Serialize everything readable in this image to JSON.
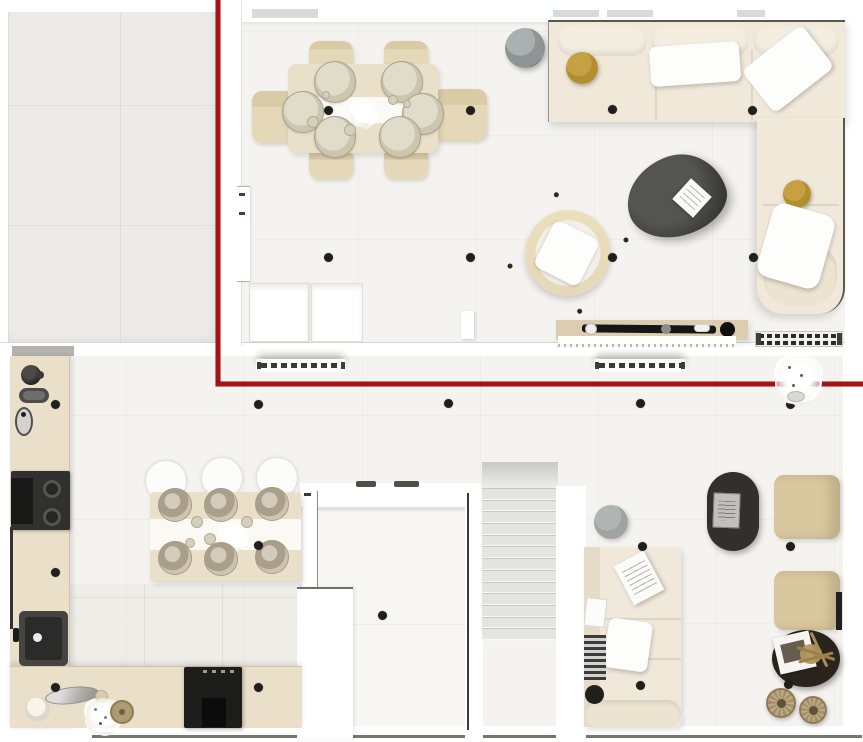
{
  "colors": {
    "wall": "#ffffff",
    "floor_main": "#f4f3f0",
    "floor_gray": "#ecebe7",
    "floor_hall": "#f7f6f3",
    "wood": "#eadfc8",
    "wood_dark": "#dccdb0",
    "chair_wood": "#e4d8b8",
    "cream": "#f0e8d9",
    "beige_chair": "#d9c79e",
    "mustard": "#b28e2f",
    "charcoal": "#343433",
    "black_item": "#1d1d1c",
    "gray_table": "#8f9494",
    "gray_pouf": "#9fa3a2",
    "wicker": "#b9a67e",
    "dark_table": "#2b241d",
    "annotation_red": "#a91113",
    "ceiling_dot": "#1f1f1e",
    "stair_tread": "#e4e4e2",
    "bottom_line": "#76746f"
  },
  "annotation": {
    "color": "#a91113",
    "vertical_line": {
      "x": 216,
      "y1": 0,
      "y2": 386,
      "thickness": 4
    },
    "horizontal_line": {
      "y": 382,
      "x1": 216,
      "x2": 863,
      "thickness": 4
    }
  },
  "ceiling_lights": [
    [
      328,
      110
    ],
    [
      470,
      110
    ],
    [
      612,
      109
    ],
    [
      752,
      110
    ],
    [
      328,
      257
    ],
    [
      470,
      257
    ],
    [
      612,
      257
    ],
    [
      753,
      257
    ],
    [
      55,
      404
    ],
    [
      258,
      404
    ],
    [
      448,
      403
    ],
    [
      640,
      403
    ],
    [
      790,
      404
    ],
    [
      55,
      572
    ],
    [
      258,
      545
    ],
    [
      382,
      615
    ],
    [
      642,
      546
    ],
    [
      790,
      546
    ],
    [
      640,
      685
    ],
    [
      788,
      684
    ],
    [
      55,
      687
    ],
    [
      258,
      687
    ]
  ],
  "stairs": {
    "tread_count": 13
  },
  "upper_dining": {
    "plate_radius": 21,
    "plates": [
      [
        335,
        82
      ],
      [
        402,
        82
      ],
      [
        303,
        112
      ],
      [
        423,
        114
      ],
      [
        335,
        137
      ],
      [
        400,
        137
      ]
    ],
    "bowls": [
      [
        313,
        122,
        6
      ],
      [
        350,
        130,
        6
      ],
      [
        393,
        100,
        5
      ],
      [
        407,
        104,
        4
      ],
      [
        326,
        95,
        4
      ]
    ]
  },
  "lower_dining": {
    "plate_radius": 17,
    "plates": [
      [
        175,
        505
      ],
      [
        221,
        505
      ],
      [
        272,
        504
      ],
      [
        175,
        558
      ],
      [
        221,
        559
      ],
      [
        272,
        557
      ]
    ],
    "bowls": [
      [
        197,
        522,
        6
      ],
      [
        247,
        522,
        6
      ],
      [
        210,
        539,
        6
      ],
      [
        190,
        543,
        5
      ]
    ],
    "chair_radius": 20,
    "chairs": [
      [
        166,
        481
      ],
      [
        222,
        478
      ],
      [
        277,
        478
      ]
    ]
  }
}
